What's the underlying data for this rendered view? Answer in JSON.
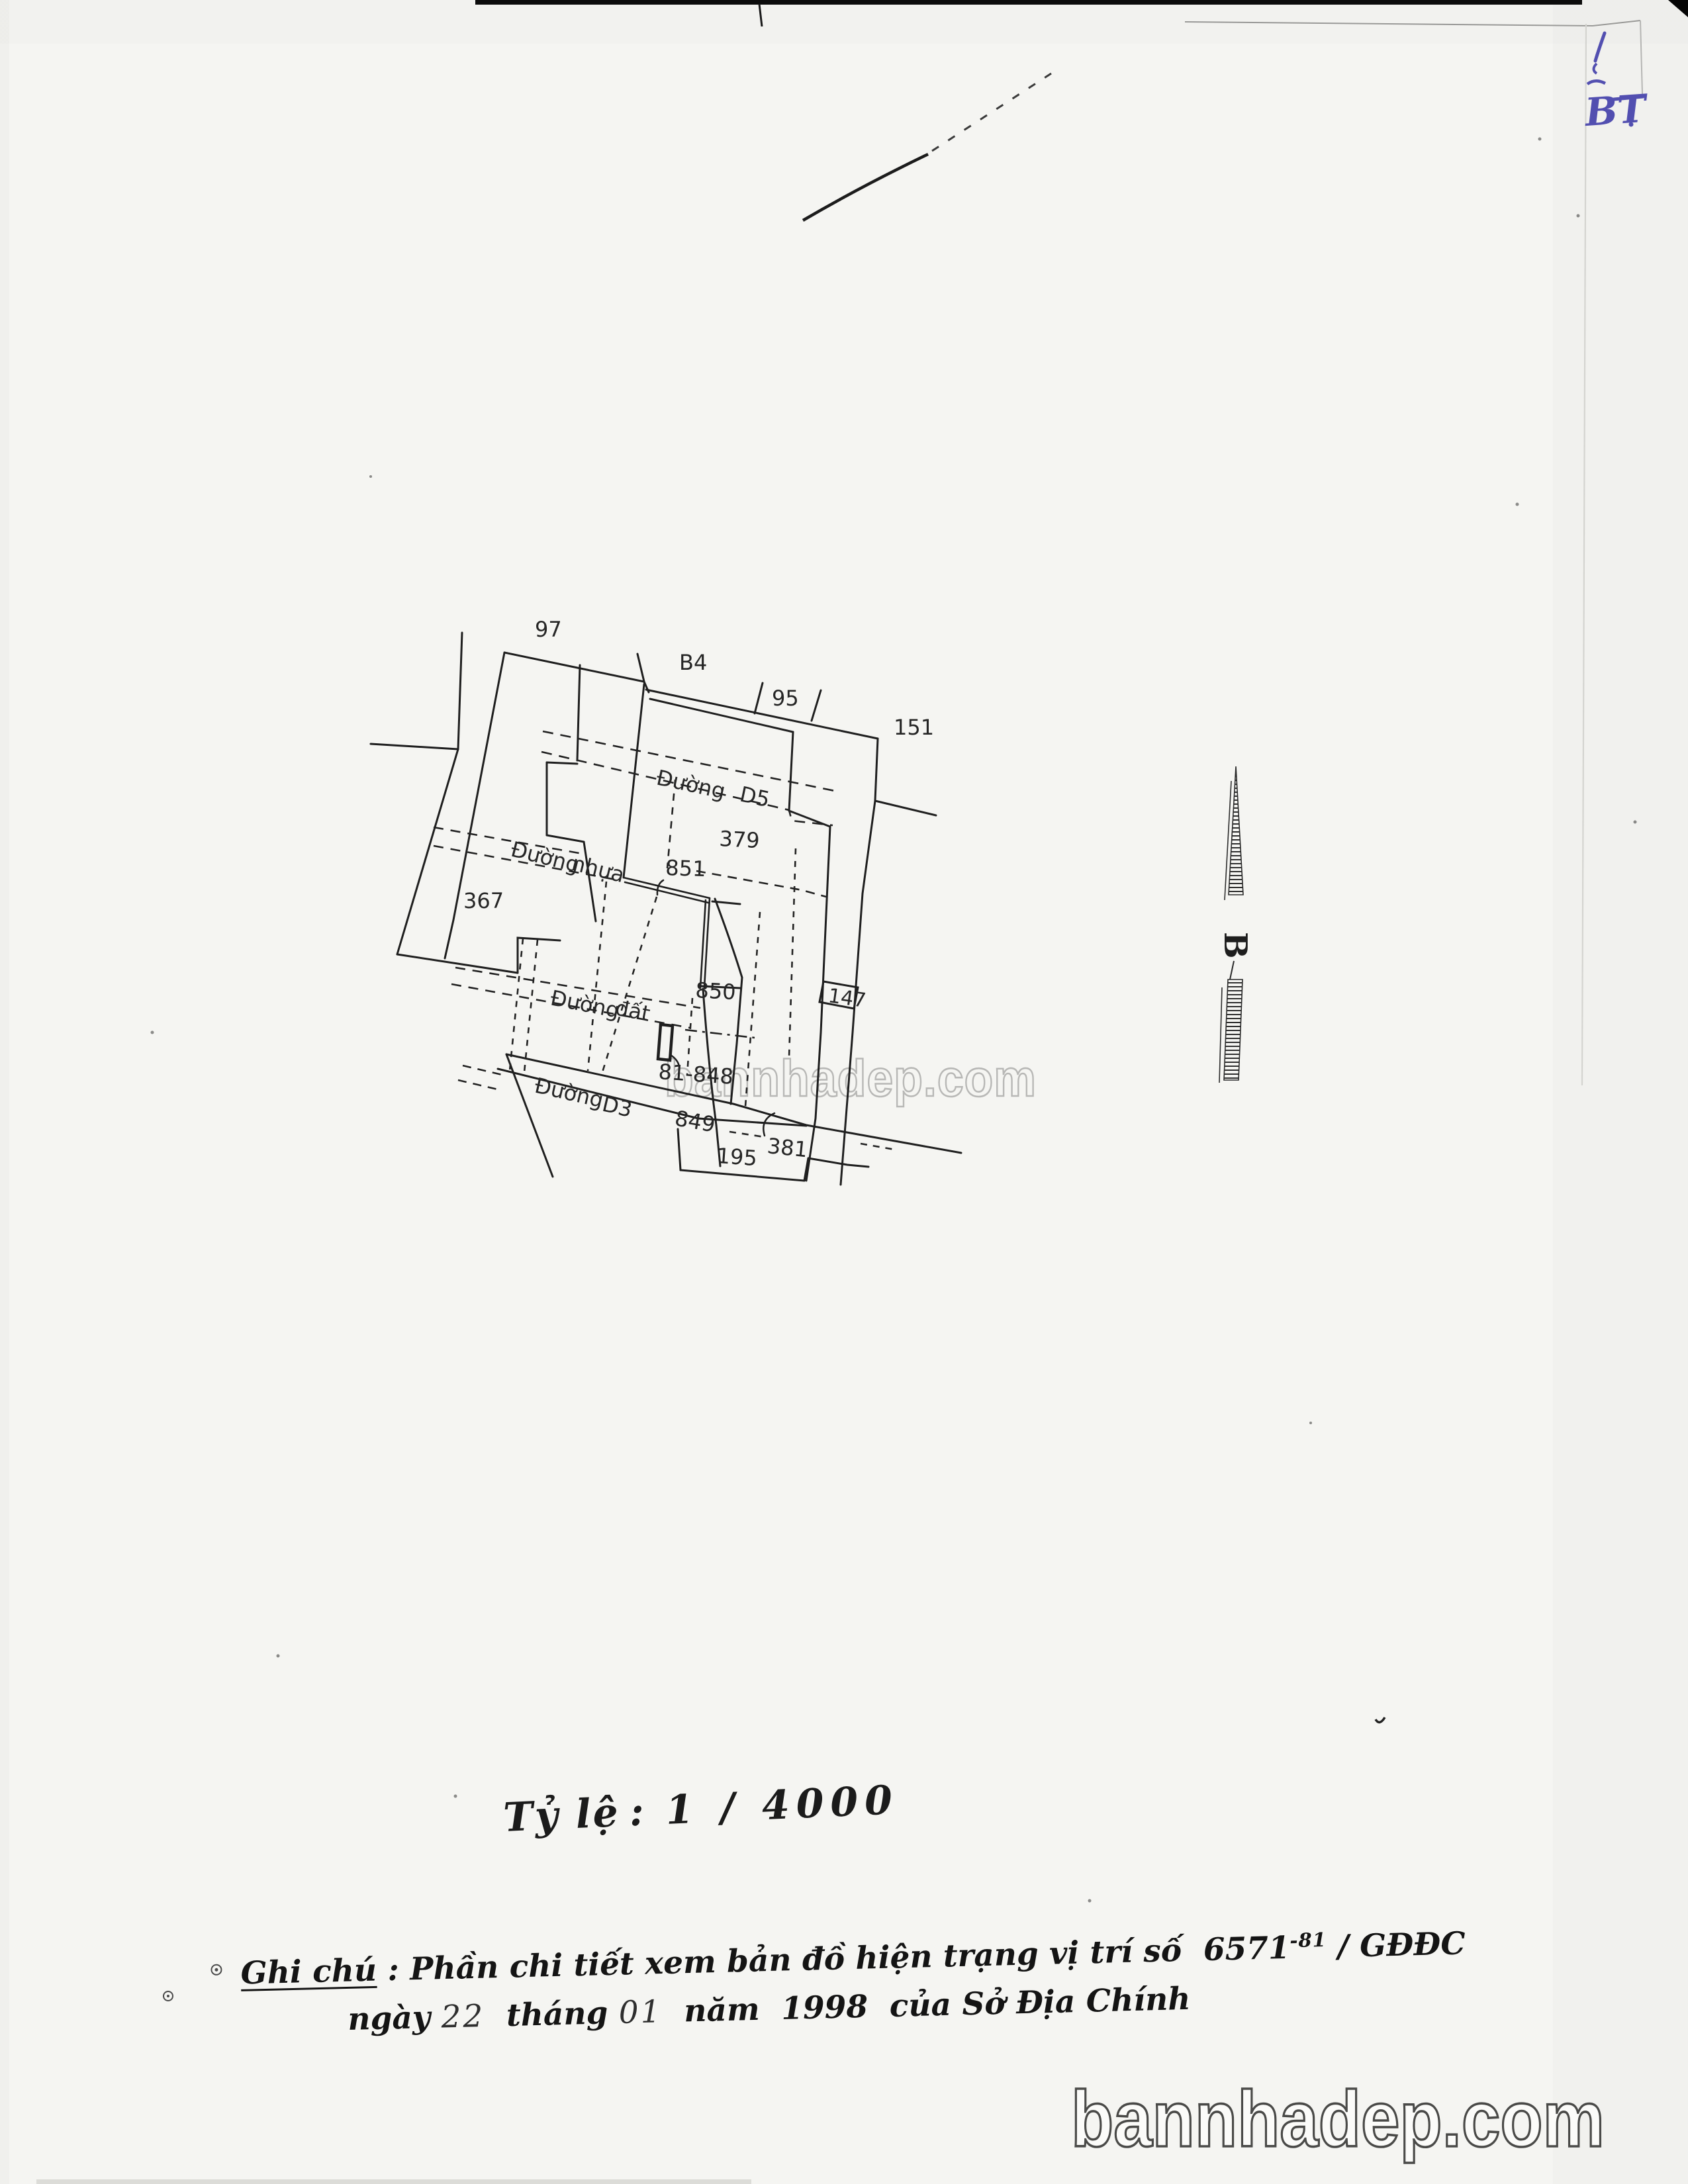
{
  "page": {
    "paper_color": "#f5f5f2",
    "ink_color": "#1f1f1f",
    "handwriting_color": "#524fb0",
    "watermark_text": "bannhadep.com"
  },
  "map": {
    "north_letter": "B",
    "parcels": [
      {
        "id": "97"
      },
      {
        "id": "B4"
      },
      {
        "id": "95"
      },
      {
        "id": "151"
      },
      {
        "id": "379"
      },
      {
        "id": "851"
      },
      {
        "id": "367"
      },
      {
        "id": "850"
      },
      {
        "id": "147"
      },
      {
        "id": "81-848"
      },
      {
        "id": "849"
      },
      {
        "id": "381"
      },
      {
        "id": "195"
      }
    ],
    "roads": [
      {
        "word1": "Đường",
        "word2": "D5"
      },
      {
        "word1": "Đường",
        "word2": "nhựa"
      },
      {
        "word1": "Đường",
        "word2": "đất"
      },
      {
        "word1": "Đường",
        "word2": "D3"
      }
    ]
  },
  "scale": {
    "label": "Tỷ lệ",
    "separator": ":",
    "value": "1 / 4000"
  },
  "note": {
    "heading": "Ghi chú",
    "colon": ":",
    "body": "Phần chi tiết xem bản đồ hiện trạng vị trí số",
    "doc_number": "6571",
    "doc_superscript": "-81",
    "doc_tail": "/ GĐĐC",
    "line2": {
      "w_ngay": "ngày",
      "day": "22",
      "w_thang": "tháng",
      "month": "01",
      "w_nam": "năm",
      "year": "1998",
      "tail": "của Sở Địa Chính"
    }
  },
  "handwriting": {
    "text": "BT"
  }
}
